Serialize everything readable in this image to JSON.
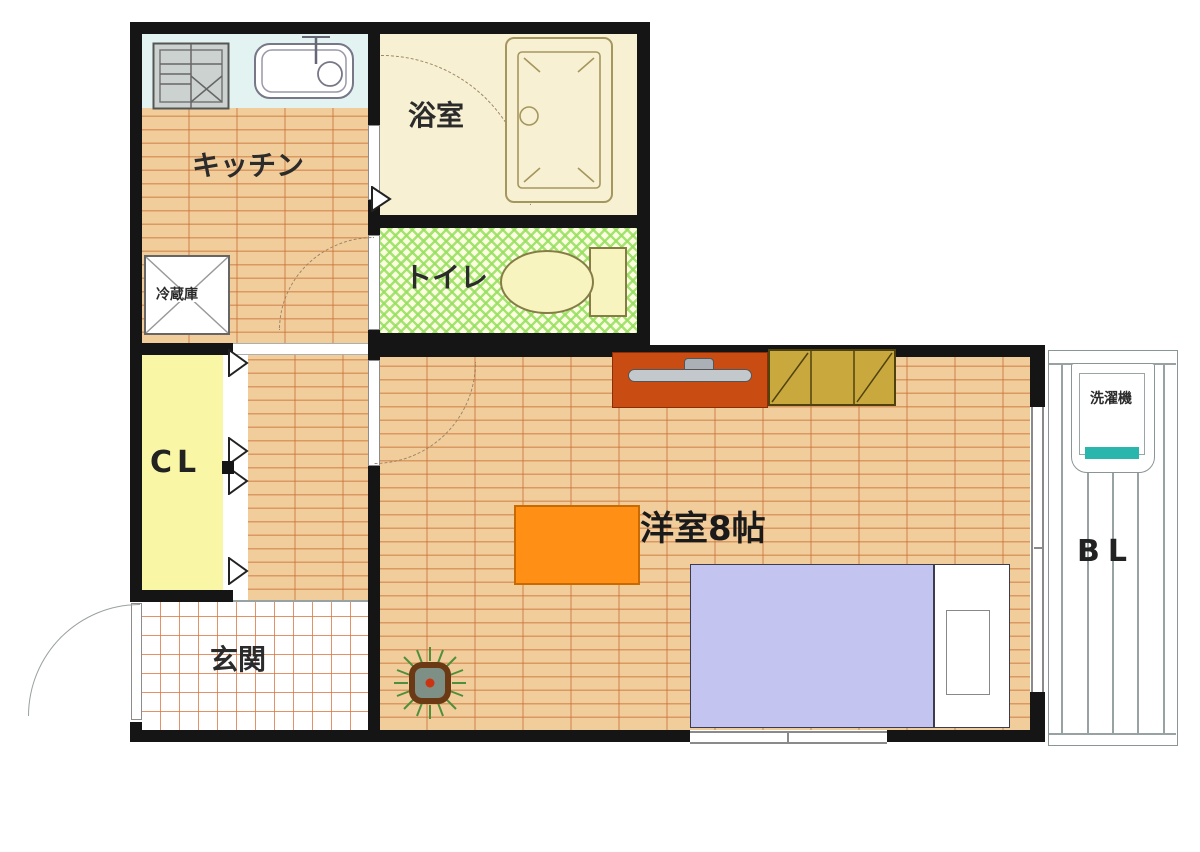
{
  "plan_type": "apartment-floor-plan",
  "labels": {
    "kitchen": "キッチン",
    "bathroom": "浴室",
    "toilet": "トイレ",
    "refrigerator": "冷蔵庫",
    "closet": "CL",
    "entrance": "玄関",
    "main_room": "洋室8帖",
    "balcony": "BL",
    "washing_machine": "洗濯機"
  },
  "colors": {
    "wall": "#151515",
    "wood_floor": "#f1cd9c",
    "wood_plank_line": "#c86e32",
    "kitchen_counter": "#e2f3f1",
    "bathroom_floor": "#f8f0d2",
    "toilet_floor_hatch": "#96de5f",
    "closet_fill": "#f9f7a5",
    "entrance_tile_line": "#dc7644",
    "bed_blanket": "#c4c4f0",
    "table": "#ff9015",
    "tv_board": "#c94d12",
    "cabinet": "#c9a83e",
    "washer_accent": "#2ab5ad",
    "plant_pot": "#6b3a14",
    "plant_leaf": "#4f8f3c"
  }
}
